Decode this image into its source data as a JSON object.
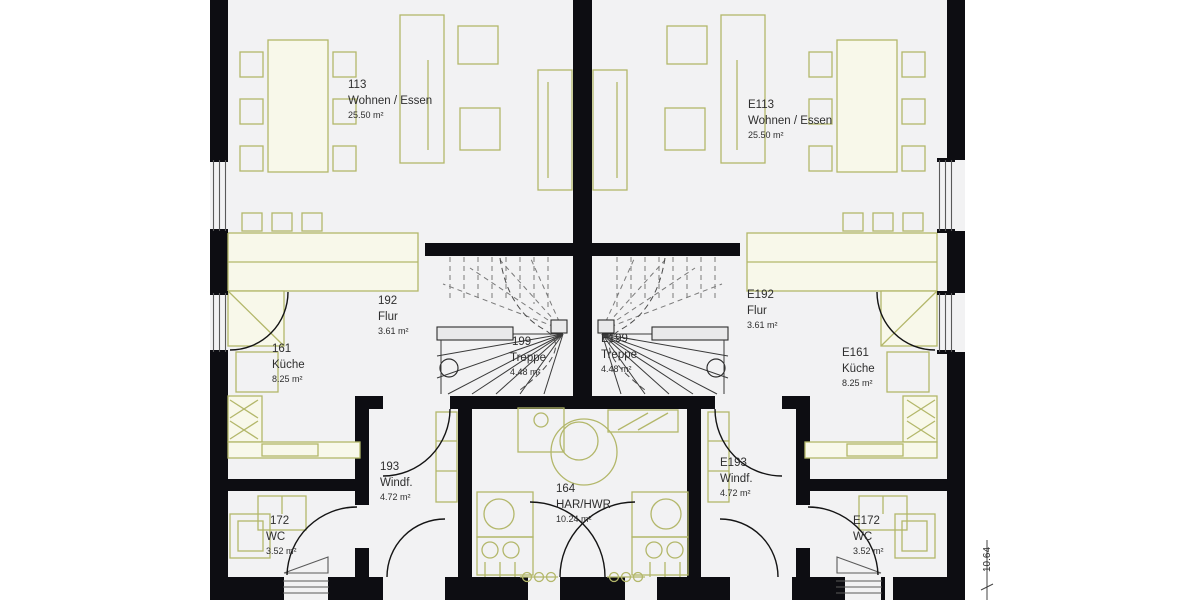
{
  "plan": {
    "type": "floor-plan",
    "dimension_right": "10.64",
    "colors": {
      "wall": "#0d0d12",
      "furniture": "#b3b76a",
      "furniture_fill": "#f8f8ea",
      "room_background": "#f2f2f3",
      "page_background": "#ffffff",
      "text": "#2e2e2e"
    },
    "rooms": [
      {
        "number": "113",
        "name": "Wohnen / Essen",
        "area": "25.50 m²"
      },
      {
        "number": "192",
        "name": "Flur",
        "area": "3.61 m²"
      },
      {
        "number": "199",
        "name": "Treppe",
        "area": "4.48 m²"
      },
      {
        "number": "161",
        "name": "Küche",
        "area": "8.25 m²"
      },
      {
        "number": "193",
        "name": "Windf.",
        "area": "4.72 m²"
      },
      {
        "number": "172",
        "name": "WC",
        "area": "3.52 m²"
      },
      {
        "number": "164",
        "name": "HAR/HWR",
        "area": "10.24 m²"
      },
      {
        "number": "E113",
        "name": "Wohnen / Essen",
        "area": "25.50 m²"
      },
      {
        "number": "E192",
        "name": "Flur",
        "area": "3.61 m²"
      },
      {
        "number": "E199",
        "name": "Treppe",
        "area": "4.48 m²"
      },
      {
        "number": "E161",
        "name": "Küche",
        "area": "8.25 m²"
      },
      {
        "number": "E193",
        "name": "Windf.",
        "area": "4.72 m²"
      },
      {
        "number": "E172",
        "name": "WC",
        "area": "3.52 m²"
      }
    ]
  }
}
